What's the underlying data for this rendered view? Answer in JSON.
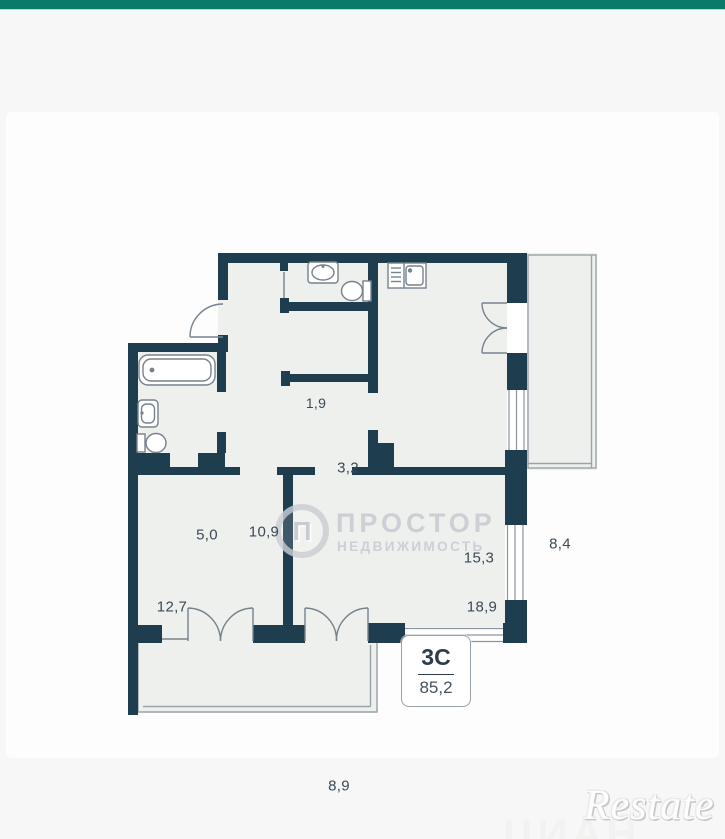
{
  "header": {
    "bar_color": "#0a7a69"
  },
  "plan": {
    "rooms": [
      {
        "name": "wc",
        "area": "1,9"
      },
      {
        "name": "corridor",
        "area": "3,2"
      },
      {
        "name": "bathroom",
        "area": "5,0"
      },
      {
        "name": "hall",
        "area": "10,9"
      },
      {
        "name": "kitchen",
        "area": "15,3"
      },
      {
        "name": "balcony",
        "area": "8,4"
      },
      {
        "name": "bedroom",
        "area": "12,7"
      },
      {
        "name": "living",
        "area": "18,9"
      },
      {
        "name": "loggia",
        "area": "8,9"
      }
    ],
    "unit": {
      "type": "3С",
      "total_area": "85,2"
    },
    "watermark": {
      "logo_letter": "П",
      "title": "ПРОСТОР",
      "subtitle": "НЕДВИЖИМОСТЬ"
    },
    "colors": {
      "wall": "#1e3d4e",
      "room_fill": "#eef0ee",
      "thin_line": "#8a949b",
      "label": "#3b4a55"
    }
  },
  "watermarks": {
    "ghost": "ЦИАН",
    "brand": "Restate"
  }
}
